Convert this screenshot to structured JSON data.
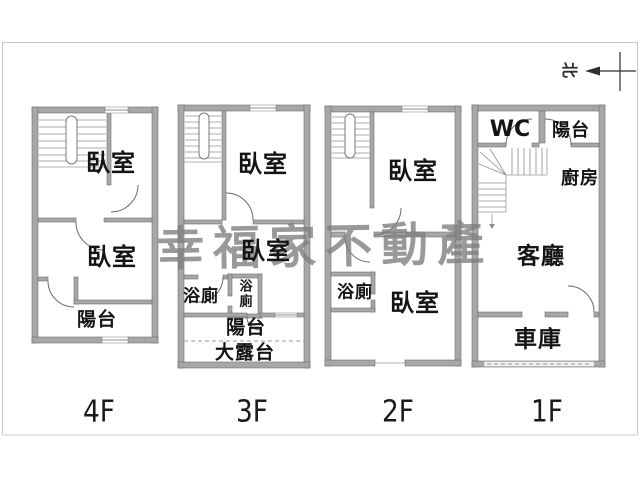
{
  "page": {
    "background": "#ffffff",
    "border_color": "#c8c8c8"
  },
  "colors": {
    "wall": "#a7a7a7",
    "wall_edge": "#6f6f6f",
    "line": "#6a6a6a",
    "text": "#141414",
    "watermark": "#808080"
  },
  "watermark": {
    "text": "幸福家不動產"
  },
  "north": {
    "label": "北"
  },
  "floors": [
    {
      "id": "4F",
      "label": "4F",
      "rooms": {
        "bedroom1": "臥室",
        "bedroom2": "臥室",
        "balcony": "陽台"
      }
    },
    {
      "id": "3F",
      "label": "3F",
      "rooms": {
        "bedroom1": "臥室",
        "bedroom2": "臥室",
        "bath": "浴廁",
        "bath_small": "浴廁",
        "balcony": "陽台",
        "terrace": "大露台"
      }
    },
    {
      "id": "2F",
      "label": "2F",
      "rooms": {
        "bedroom1": "臥室",
        "bedroom2": "臥室",
        "bath": "浴廁"
      }
    },
    {
      "id": "1F",
      "label": "1F",
      "rooms": {
        "wc": "WC",
        "balcony": "陽台",
        "kitchen": "廚房",
        "living": "客廳",
        "garage": "車庫"
      }
    }
  ]
}
